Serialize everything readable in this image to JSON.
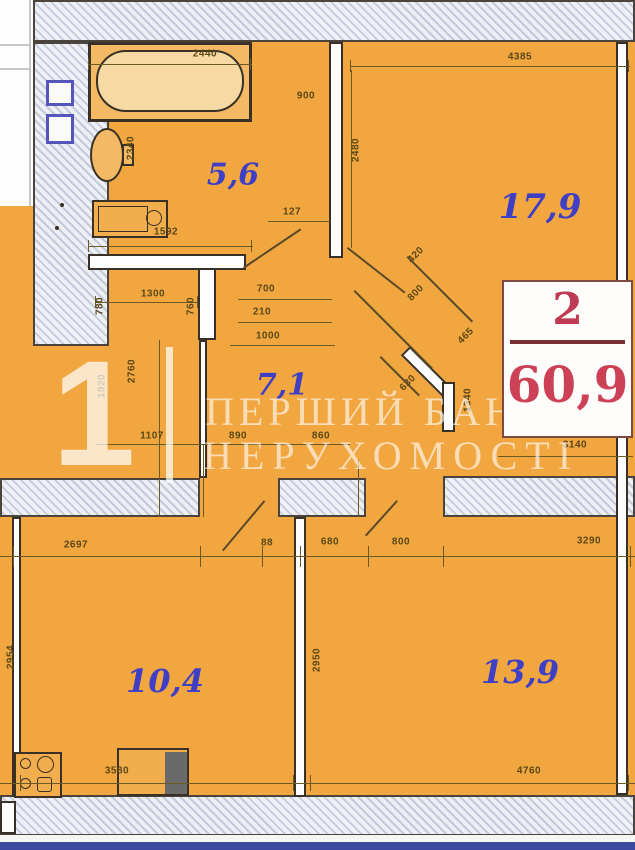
{
  "plan_title": "apartment-floor-plan",
  "rooms": {
    "bathroom_area": "5,6",
    "living_area": "17,9",
    "hall_area": "7,1",
    "kitchen_area": "10,4",
    "bedroom_area": "13,9"
  },
  "badge": {
    "room_count": "2",
    "total_area": "60,9"
  },
  "watermark": {
    "numeral": "1",
    "line1": "ПЕРШИЙ БАНК",
    "line2": "НЕРУХОМОСТІ"
  },
  "dims": {
    "bath_top": "2440",
    "living_top": "4385",
    "bath_right": "900",
    "wc": "2340",
    "bath_sink": "1592",
    "bath_door": "127",
    "living_left": "2480",
    "entry_door": "420",
    "entry_a": "800",
    "entry_b": "465",
    "entry_c": "630",
    "vestibule": "1340",
    "badge_bottom": "3140",
    "niche_w": "700",
    "niche_d": "210",
    "niche_total": "1000",
    "closet_w": "1300",
    "closet_a": "780",
    "closet_b": "760",
    "closet_h": "2760",
    "closet_left": "1920",
    "hall_a": "1107",
    "hall_b": "890",
    "hall_c": "860",
    "kitchen_top": "2697",
    "cor_a": "88",
    "cor_b": "680",
    "cor_c": "800",
    "bedroom_top": "3290",
    "kitchen_left": "2954",
    "bedroom_left": "2950",
    "kitchen_bottom": "3580",
    "bedroom_bottom": "4760"
  },
  "icons": {
    "bathtub": "bathtub-icon",
    "toilet": "toilet-icon",
    "sink": "washer-sink-icon",
    "stove": "gas-stove-icon",
    "counter": "kitchen-counter-icon",
    "panel": "electric-panel-icon"
  },
  "colors": {
    "floor_orange": "#f1a640",
    "wall_hatch": "#c3cad9",
    "area_label_blue": "#3f3fc6",
    "dim_label_brown": "#5c4715",
    "badge_red": "#cc4156",
    "baseline_blue": "#3b4aa0",
    "watermark_white": "#ffffff"
  }
}
